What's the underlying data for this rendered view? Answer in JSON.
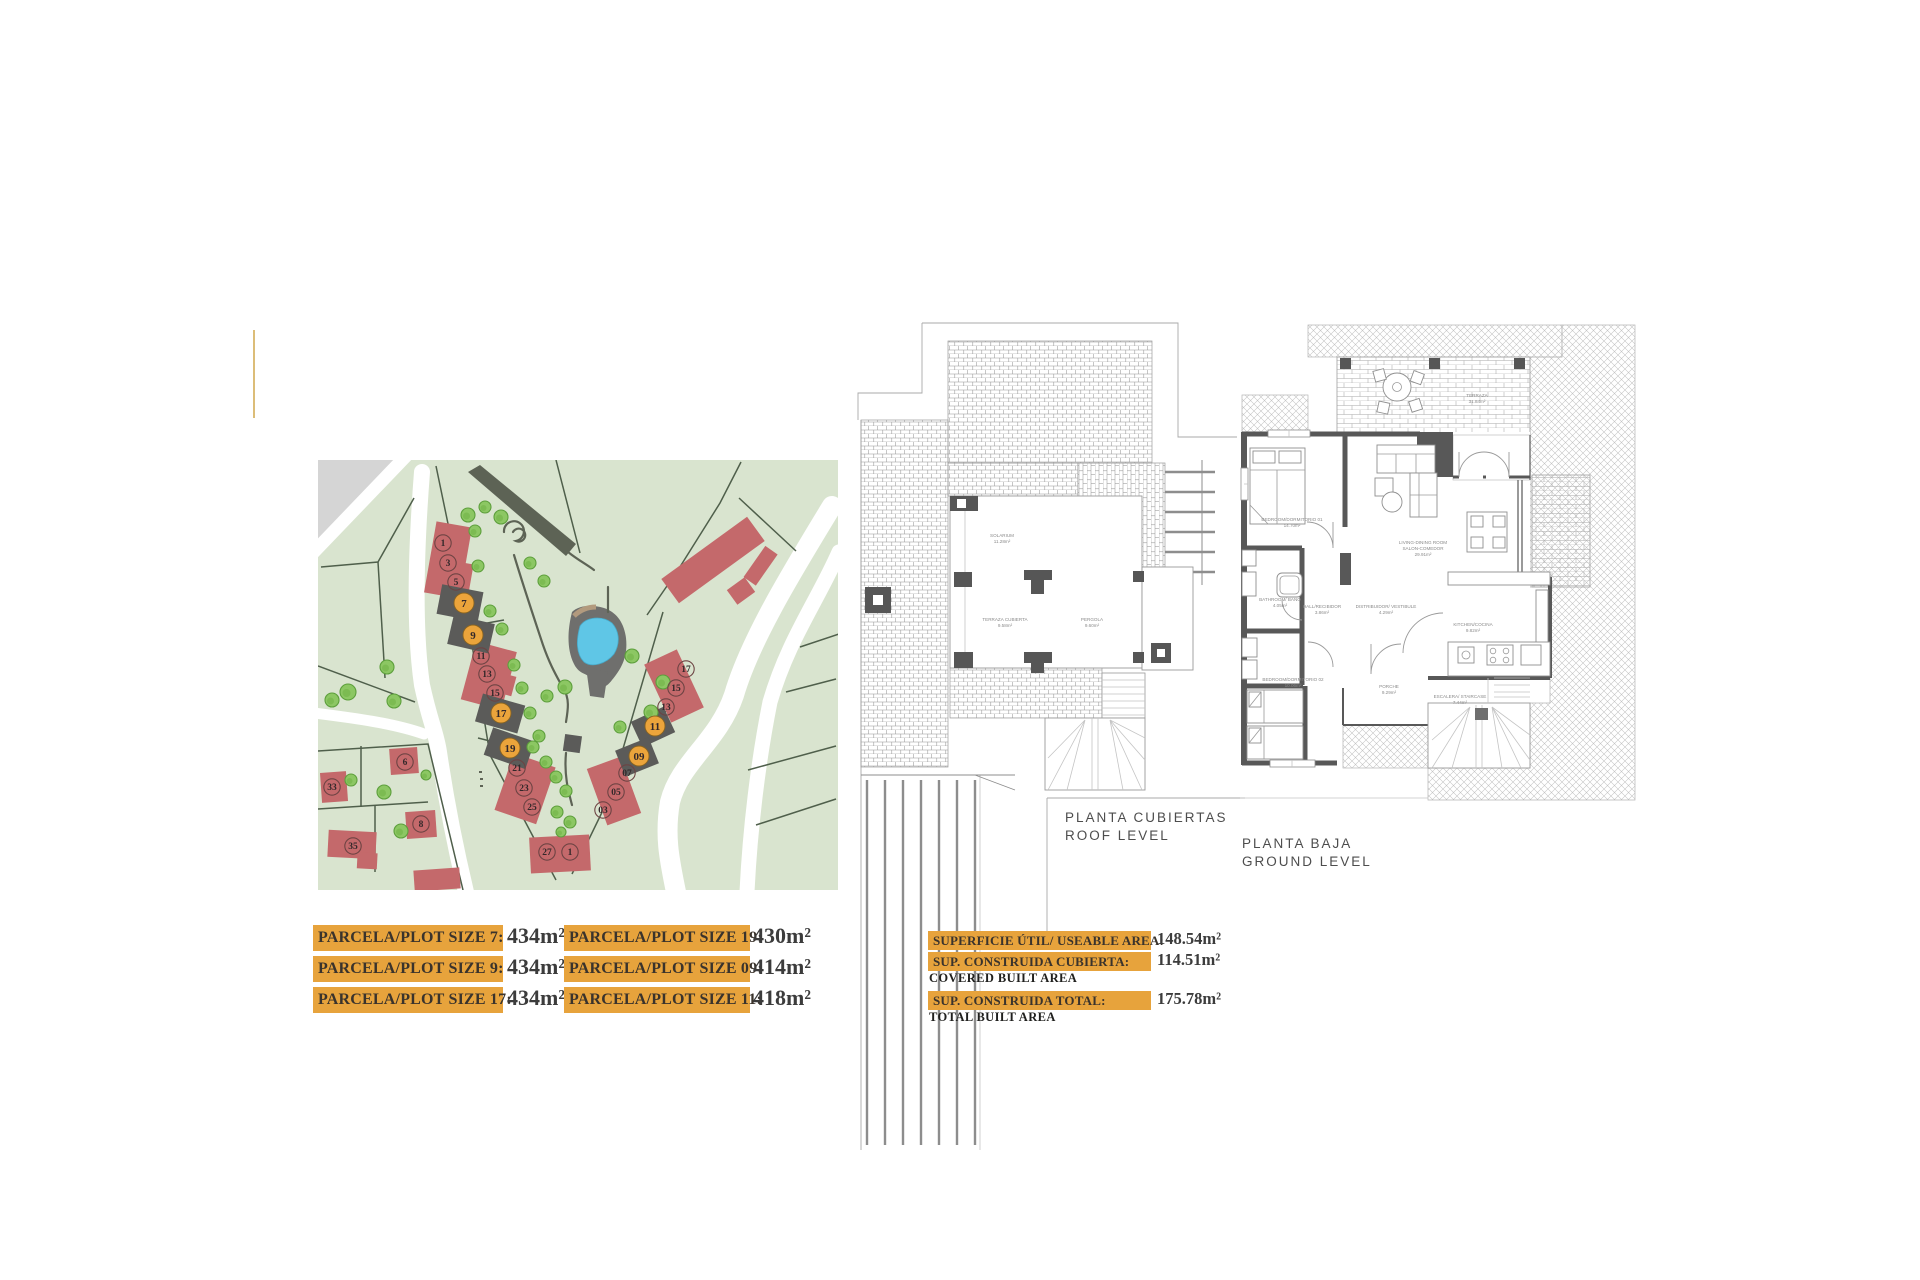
{
  "plot_sizes": {
    "col1": [
      {
        "label": "PARCELA/PLOT SIZE 7:",
        "value": "434m²"
      },
      {
        "label": "PARCELA/PLOT SIZE 9:",
        "value": "434m²"
      },
      {
        "label": "PARCELA/PLOT SIZE 17:",
        "value": "434m²"
      }
    ],
    "col2": [
      {
        "label": "PARCELA/PLOT SIZE 19:",
        "value": "430m²"
      },
      {
        "label": "PARCELA/PLOT SIZE 09:",
        "value": "414m²"
      },
      {
        "label": "PARCELA/PLOT SIZE 11:",
        "value": "418m²"
      }
    ]
  },
  "areas": [
    {
      "label": "SUPERFICIE ÚTIL/ USEABLE AREA:",
      "value": "148.54m²",
      "sub": ""
    },
    {
      "label": "SUP. CONSTRUIDA CUBIERTA:",
      "value": "114.51m²",
      "sub": "COVERED BUILT AREA"
    },
    {
      "label": "SUP. CONSTRUIDA TOTAL:",
      "value": "175.78m²",
      "sub": "TOTAL BUILT AREA"
    }
  ],
  "site_map": {
    "colors": {
      "green": "#d9e4cf",
      "road": "#ffffff",
      "gray_area": "#d5d5d5",
      "building": "#c4696b",
      "building_dark": "#5b5b59",
      "highlight": "#eba43b",
      "tree": "#8cc763",
      "tree_edge": "#5d9f3c",
      "path": "#5d6355",
      "pool_water": "#5fc6e6",
      "pool_deck": "#b29a7e",
      "boundary": "#4f5f4b"
    },
    "plots": [
      {
        "n": "1",
        "x": 125,
        "y": 83,
        "hl": 0
      },
      {
        "n": "3",
        "x": 130,
        "y": 103,
        "hl": 0
      },
      {
        "n": "5",
        "x": 138,
        "y": 122,
        "hl": 0
      },
      {
        "n": "7",
        "x": 146,
        "y": 143,
        "hl": 1
      },
      {
        "n": "9",
        "x": 155,
        "y": 175,
        "hl": 1
      },
      {
        "n": "11",
        "x": 163,
        "y": 196,
        "hl": 0
      },
      {
        "n": "13",
        "x": 169,
        "y": 214,
        "hl": 0
      },
      {
        "n": "15",
        "x": 177,
        "y": 233,
        "hl": 0
      },
      {
        "n": "17",
        "x": 183,
        "y": 253,
        "hl": 1
      },
      {
        "n": "19",
        "x": 192,
        "y": 288,
        "hl": 1
      },
      {
        "n": "21",
        "x": 199,
        "y": 308,
        "hl": 0
      },
      {
        "n": "23",
        "x": 206,
        "y": 328,
        "hl": 0
      },
      {
        "n": "25",
        "x": 214,
        "y": 347,
        "hl": 0
      },
      {
        "n": "27",
        "x": 229,
        "y": 392,
        "hl": 0
      },
      {
        "n": "1",
        "x": 252,
        "y": 392,
        "hl": 0
      },
      {
        "n": "17",
        "x": 368,
        "y": 209,
        "hl": 0
      },
      {
        "n": "15",
        "x": 358,
        "y": 228,
        "hl": 0
      },
      {
        "n": "13",
        "x": 348,
        "y": 247,
        "hl": 0
      },
      {
        "n": "11",
        "x": 337,
        "y": 266,
        "hl": 1
      },
      {
        "n": "09",
        "x": 321,
        "y": 296,
        "hl": 1
      },
      {
        "n": "07",
        "x": 309,
        "y": 313,
        "hl": 0
      },
      {
        "n": "05",
        "x": 298,
        "y": 332,
        "hl": 0
      },
      {
        "n": "03",
        "x": 285,
        "y": 350,
        "hl": 0
      },
      {
        "n": "33",
        "x": 14,
        "y": 327,
        "hl": 0
      },
      {
        "n": "6",
        "x": 87,
        "y": 302,
        "hl": 0
      },
      {
        "n": "8",
        "x": 103,
        "y": 364,
        "hl": 0
      },
      {
        "n": "35",
        "x": 35,
        "y": 386,
        "hl": 0
      }
    ],
    "trees": [
      {
        "x": 150,
        "y": 55,
        "r": 7
      },
      {
        "x": 167,
        "y": 47,
        "r": 6
      },
      {
        "x": 183,
        "y": 57,
        "r": 7
      },
      {
        "x": 157,
        "y": 71,
        "r": 6
      },
      {
        "x": 212,
        "y": 103,
        "r": 6
      },
      {
        "x": 226,
        "y": 121,
        "r": 6
      },
      {
        "x": 160,
        "y": 106,
        "r": 6
      },
      {
        "x": 172,
        "y": 151,
        "r": 6
      },
      {
        "x": 184,
        "y": 169,
        "r": 6
      },
      {
        "x": 196,
        "y": 205,
        "r": 6
      },
      {
        "x": 204,
        "y": 228,
        "r": 6
      },
      {
        "x": 212,
        "y": 253,
        "r": 6
      },
      {
        "x": 221,
        "y": 276,
        "r": 6
      },
      {
        "x": 229,
        "y": 236,
        "r": 6
      },
      {
        "x": 247,
        "y": 227,
        "r": 7
      },
      {
        "x": 314,
        "y": 196,
        "r": 7
      },
      {
        "x": 345,
        "y": 222,
        "r": 7
      },
      {
        "x": 333,
        "y": 252,
        "r": 7
      },
      {
        "x": 302,
        "y": 267,
        "r": 6
      },
      {
        "x": 215,
        "y": 287,
        "r": 6
      },
      {
        "x": 228,
        "y": 302,
        "r": 6
      },
      {
        "x": 238,
        "y": 317,
        "r": 6
      },
      {
        "x": 248,
        "y": 331,
        "r": 6
      },
      {
        "x": 239,
        "y": 352,
        "r": 6
      },
      {
        "x": 252,
        "y": 362,
        "r": 6
      },
      {
        "x": 243,
        "y": 372,
        "r": 5
      },
      {
        "x": 30,
        "y": 232,
        "r": 8
      },
      {
        "x": 69,
        "y": 207,
        "r": 7
      },
      {
        "x": 76,
        "y": 241,
        "r": 7
      },
      {
        "x": 14,
        "y": 240,
        "r": 7
      },
      {
        "x": 33,
        "y": 320,
        "r": 6
      },
      {
        "x": 66,
        "y": 332,
        "r": 7
      },
      {
        "x": 108,
        "y": 315,
        "r": 5
      },
      {
        "x": 83,
        "y": 371,
        "r": 7
      }
    ]
  },
  "roof_plan": {
    "title1": "PLANTA CUBIERTAS",
    "title2": "ROOF LEVEL",
    "labels": [
      {
        "t": "SOLARIUM",
        "x": 147,
        "y": 247
      },
      {
        "t": "11.28m²",
        "x": 147,
        "y": 253
      },
      {
        "t": "TERRAZA CUBIERTA",
        "x": 150,
        "y": 331
      },
      {
        "t": "9.58m²",
        "x": 150,
        "y": 337
      },
      {
        "t": "PERGOLA",
        "x": 237,
        "y": 331
      },
      {
        "t": "9.60m²",
        "x": 237,
        "y": 337
      }
    ]
  },
  "ground_plan": {
    "title1": "PLANTA BAJA",
    "title2": "GROUND LEVEL",
    "labels": [
      {
        "t": "TERRAZA",
        "x": 237,
        "y": 77
      },
      {
        "t": "31.84m²",
        "x": 237,
        "y": 83
      },
      {
        "t": "BEDROOM/DORMITORIO 01",
        "x": 52,
        "y": 201
      },
      {
        "t": "14.70m²",
        "x": 52,
        "y": 207
      },
      {
        "t": "LIVING-DINING ROOM",
        "x": 183,
        "y": 224
      },
      {
        "t": "SALON-COMEDOR",
        "x": 183,
        "y": 230
      },
      {
        "t": "29.91m²",
        "x": 183,
        "y": 236
      },
      {
        "t": "BATHROOM/ BAÑO",
        "x": 40,
        "y": 281
      },
      {
        "t": "4.05m²",
        "x": 40,
        "y": 287
      },
      {
        "t": "HALL/RECIBIDOR",
        "x": 82,
        "y": 288
      },
      {
        "t": "3.86m²",
        "x": 82,
        "y": 294
      },
      {
        "t": "DISTRIBUIDOR/ VESTIBULE",
        "x": 146,
        "y": 288
      },
      {
        "t": "4.29m²",
        "x": 146,
        "y": 294
      },
      {
        "t": "KITCHEN/COCINA",
        "x": 233,
        "y": 306
      },
      {
        "t": "9.82m²",
        "x": 233,
        "y": 312
      },
      {
        "t": "BEDROOM/DORMITORIO 02",
        "x": 53,
        "y": 361
      },
      {
        "t": "10.06m²",
        "x": 53,
        "y": 367
      },
      {
        "t": "PORCHE",
        "x": 149,
        "y": 368
      },
      {
        "t": "9.29m²",
        "x": 149,
        "y": 374
      },
      {
        "t": "ESCALERA/ STAIRCASE",
        "x": 220,
        "y": 378
      },
      {
        "t": "7.44m²",
        "x": 220,
        "y": 384
      }
    ]
  }
}
